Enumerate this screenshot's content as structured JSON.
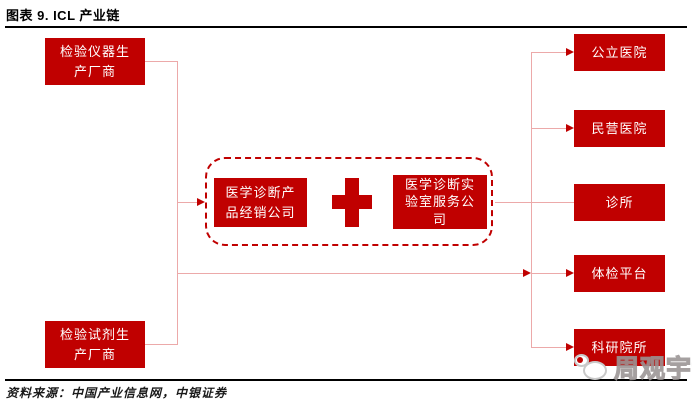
{
  "title": "图表 9. ICL 产业链",
  "footer": {
    "source": "资料来源：中国产业信息网，中银证券"
  },
  "watermark": {
    "text": "周观宇论",
    "logo": "chat-bubbles-icon"
  },
  "colors": {
    "box_red": "#C00000",
    "connector_pink": "#ECA9A9",
    "box_text_white": "#FFFFFF",
    "rule_black": "#000000"
  },
  "diagram": {
    "upstream": [
      {
        "id": "instrument-manufacturer",
        "label": "检验仪器生\n产厂商"
      },
      {
        "id": "reagent-manufacturer",
        "label": "检验试剂生\n产厂商"
      }
    ],
    "core_group": {
      "distributor": {
        "label": "医学诊断产\n品经销公司"
      },
      "plus": "+",
      "lab_service": {
        "label": "医学诊断实\n验室服务公\n司"
      }
    },
    "downstream": [
      {
        "id": "public-hospital",
        "label": "公立医院"
      },
      {
        "id": "private-hospital",
        "label": "民营医院"
      },
      {
        "id": "clinic",
        "label": "诊所"
      },
      {
        "id": "checkup-platform",
        "label": "体检平台"
      },
      {
        "id": "research-institute",
        "label": "科研院所"
      }
    ]
  }
}
